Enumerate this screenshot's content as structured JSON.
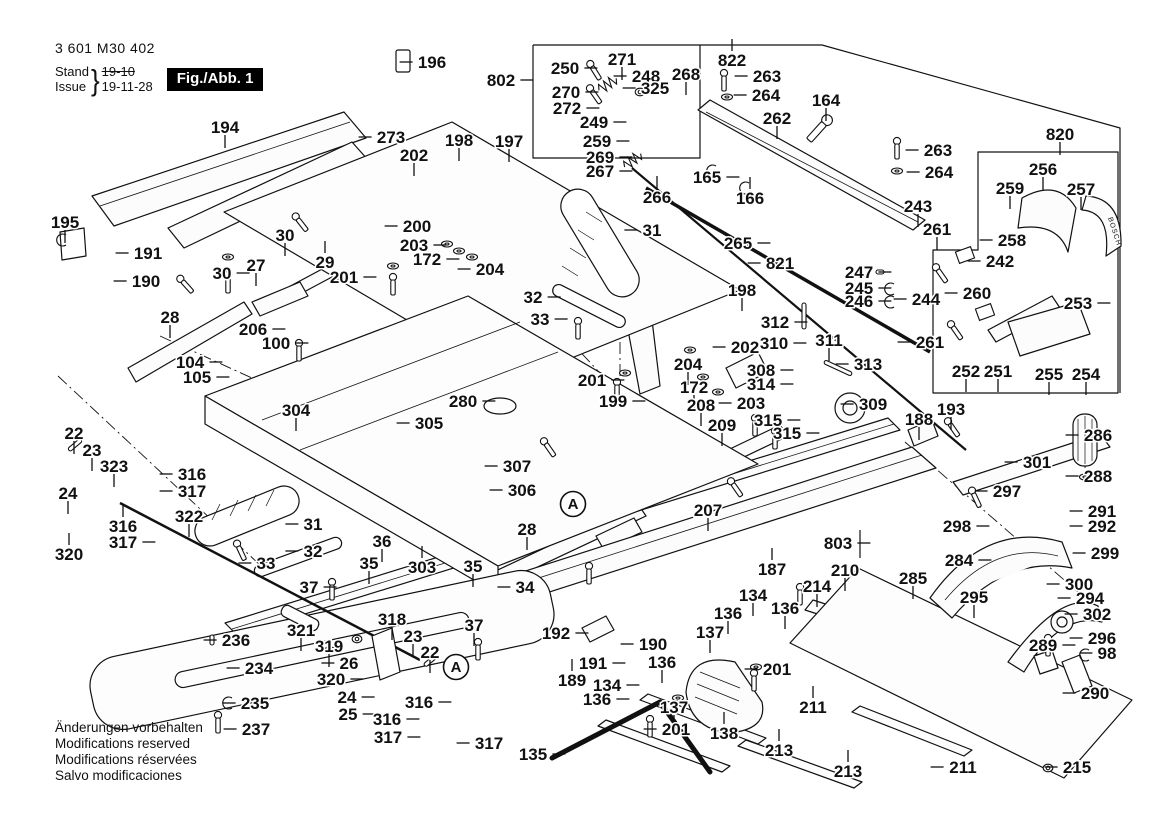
{
  "meta": {
    "part_number": "3 601 M30 402",
    "stand_label": "Stand",
    "issue_label": "Issue",
    "old_date": "19-10",
    "date": "19-11-28",
    "figure": "Fig./Abb. 1"
  },
  "footer": {
    "lines": [
      "Änderungen vorbehalten",
      "Modifications reserved",
      "Modifications réservées",
      "Salvo modificaciones"
    ]
  },
  "brand_text": "BOSCH",
  "assembly_markers": [
    {
      "label": "A",
      "x": 573,
      "y": 504
    },
    {
      "label": "A",
      "x": 456,
      "y": 667
    }
  ],
  "labels": [
    {
      "t": "196",
      "x": 432,
      "y": 62,
      "d": "l"
    },
    {
      "t": "802",
      "x": 501,
      "y": 80,
      "d": "r"
    },
    {
      "t": "250",
      "x": 565,
      "y": 68,
      "d": "r"
    },
    {
      "t": "271",
      "x": 622,
      "y": 59,
      "d": "d"
    },
    {
      "t": "248",
      "x": 646,
      "y": 76,
      "d": "l"
    },
    {
      "t": "268",
      "x": 686,
      "y": 74,
      "d": "d"
    },
    {
      "t": "822",
      "x": 732,
      "y": 60,
      "d": "u"
    },
    {
      "t": "263",
      "x": 767,
      "y": 76,
      "d": "l"
    },
    {
      "t": "264",
      "x": 766,
      "y": 95,
      "d": "l"
    },
    {
      "t": "270",
      "x": 566,
      "y": 92,
      "d": "r"
    },
    {
      "t": "272",
      "x": 567,
      "y": 108,
      "d": "r"
    },
    {
      "t": "325",
      "x": 655,
      "y": 88,
      "d": "l"
    },
    {
      "t": "249",
      "x": 594,
      "y": 122,
      "d": "r"
    },
    {
      "t": "259",
      "x": 597,
      "y": 141,
      "d": "r"
    },
    {
      "t": "269",
      "x": 600,
      "y": 157,
      "d": "r"
    },
    {
      "t": "267",
      "x": 600,
      "y": 171,
      "d": "r"
    },
    {
      "t": "266",
      "x": 657,
      "y": 197,
      "d": "u"
    },
    {
      "t": "165",
      "x": 707,
      "y": 177,
      "d": "r"
    },
    {
      "t": "166",
      "x": 750,
      "y": 198,
      "d": "u"
    },
    {
      "t": "262",
      "x": 777,
      "y": 118,
      "d": "d"
    },
    {
      "t": "164",
      "x": 826,
      "y": 100,
      "d": "d"
    },
    {
      "t": "194",
      "x": 225,
      "y": 127,
      "d": "d"
    },
    {
      "t": "273",
      "x": 391,
      "y": 137,
      "d": "l"
    },
    {
      "t": "198",
      "x": 459,
      "y": 140,
      "d": "d"
    },
    {
      "t": "197",
      "x": 509,
      "y": 141,
      "d": "d"
    },
    {
      "t": "202",
      "x": 414,
      "y": 155,
      "d": "d"
    },
    {
      "t": "263",
      "x": 938,
      "y": 150,
      "d": "l"
    },
    {
      "t": "264",
      "x": 939,
      "y": 172,
      "d": "l"
    },
    {
      "t": "243",
      "x": 918,
      "y": 206,
      "d": "d"
    },
    {
      "t": "820",
      "x": 1060,
      "y": 134,
      "d": "d"
    },
    {
      "t": "256",
      "x": 1043,
      "y": 169,
      "d": "d"
    },
    {
      "t": "259",
      "x": 1010,
      "y": 188,
      "d": "d"
    },
    {
      "t": "257",
      "x": 1081,
      "y": 189,
      "d": "d"
    },
    {
      "t": "258",
      "x": 1012,
      "y": 240,
      "d": "l"
    },
    {
      "t": "242",
      "x": 1000,
      "y": 261,
      "d": "l"
    },
    {
      "t": "261",
      "x": 937,
      "y": 229,
      "d": "d"
    },
    {
      "t": "195",
      "x": 65,
      "y": 222,
      "d": "d"
    },
    {
      "t": "191",
      "x": 148,
      "y": 253,
      "d": "l"
    },
    {
      "t": "190",
      "x": 146,
      "y": 281,
      "d": "l"
    },
    {
      "t": "30",
      "x": 285,
      "y": 235,
      "d": "d"
    },
    {
      "t": "29",
      "x": 325,
      "y": 262,
      "d": "u"
    },
    {
      "t": "27",
      "x": 256,
      "y": 265,
      "d": "d"
    },
    {
      "t": "30",
      "x": 222,
      "y": 273,
      "d": "r"
    },
    {
      "t": "201",
      "x": 344,
      "y": 277,
      "d": "r"
    },
    {
      "t": "200",
      "x": 417,
      "y": 226,
      "d": "l"
    },
    {
      "t": "203",
      "x": 414,
      "y": 245,
      "d": "r"
    },
    {
      "t": "172",
      "x": 427,
      "y": 259,
      "d": "r"
    },
    {
      "t": "204",
      "x": 490,
      "y": 269,
      "d": "l"
    },
    {
      "t": "31",
      "x": 652,
      "y": 230,
      "d": "l"
    },
    {
      "t": "265",
      "x": 738,
      "y": 243,
      "d": "r"
    },
    {
      "t": "821",
      "x": 780,
      "y": 263,
      "d": "l"
    },
    {
      "t": "28",
      "x": 170,
      "y": 317,
      "d": "d"
    },
    {
      "t": "206",
      "x": 253,
      "y": 329,
      "d": "r"
    },
    {
      "t": "100",
      "x": 276,
      "y": 343,
      "d": "r"
    },
    {
      "t": "104",
      "x": 190,
      "y": 362,
      "d": "r"
    },
    {
      "t": "105",
      "x": 197,
      "y": 377,
      "d": "r"
    },
    {
      "t": "198",
      "x": 742,
      "y": 290,
      "d": "d"
    },
    {
      "t": "202",
      "x": 745,
      "y": 347,
      "d": "l"
    },
    {
      "t": "247",
      "x": 859,
      "y": 272,
      "d": "r"
    },
    {
      "t": "245",
      "x": 859,
      "y": 288,
      "d": "r"
    },
    {
      "t": "246",
      "x": 859,
      "y": 301,
      "d": "r"
    },
    {
      "t": "244",
      "x": 926,
      "y": 299,
      "d": "l"
    },
    {
      "t": "261",
      "x": 930,
      "y": 342,
      "d": "l"
    },
    {
      "t": "260",
      "x": 977,
      "y": 293,
      "d": "l"
    },
    {
      "t": "312",
      "x": 775,
      "y": 322,
      "d": "r"
    },
    {
      "t": "310",
      "x": 774,
      "y": 343,
      "d": "r"
    },
    {
      "t": "311",
      "x": 829,
      "y": 340,
      "d": "d"
    },
    {
      "t": "308",
      "x": 761,
      "y": 370,
      "d": "r"
    },
    {
      "t": "314",
      "x": 761,
      "y": 384,
      "d": "r"
    },
    {
      "t": "313",
      "x": 868,
      "y": 364,
      "d": "l"
    },
    {
      "t": "315",
      "x": 768,
      "y": 420,
      "d": "r"
    },
    {
      "t": "315",
      "x": 787,
      "y": 433,
      "d": "r"
    },
    {
      "t": "309",
      "x": 873,
      "y": 404,
      "d": "l"
    },
    {
      "t": "204",
      "x": 688,
      "y": 364,
      "d": "d"
    },
    {
      "t": "172",
      "x": 694,
      "y": 387,
      "d": "d"
    },
    {
      "t": "203",
      "x": 751,
      "y": 403,
      "d": "l"
    },
    {
      "t": "208",
      "x": 701,
      "y": 405,
      "d": "d"
    },
    {
      "t": "209",
      "x": 722,
      "y": 425,
      "d": "d"
    },
    {
      "t": "201",
      "x": 592,
      "y": 380,
      "d": "r"
    },
    {
      "t": "199",
      "x": 613,
      "y": 401,
      "d": "r"
    },
    {
      "t": "188",
      "x": 919,
      "y": 419,
      "d": "d"
    },
    {
      "t": "193",
      "x": 951,
      "y": 409,
      "d": "d"
    },
    {
      "t": "253",
      "x": 1078,
      "y": 303,
      "d": "r"
    },
    {
      "t": "252",
      "x": 966,
      "y": 371,
      "d": "d"
    },
    {
      "t": "251",
      "x": 998,
      "y": 371,
      "d": "d"
    },
    {
      "t": "255",
      "x": 1049,
      "y": 374,
      "d": "d"
    },
    {
      "t": "254",
      "x": 1086,
      "y": 374,
      "d": "d"
    },
    {
      "t": "286",
      "x": 1098,
      "y": 435,
      "d": "l"
    },
    {
      "t": "301",
      "x": 1037,
      "y": 462,
      "d": "l"
    },
    {
      "t": "288",
      "x": 1098,
      "y": 476,
      "d": "l"
    },
    {
      "t": "280",
      "x": 463,
      "y": 401,
      "d": "r"
    },
    {
      "t": "305",
      "x": 429,
      "y": 423,
      "d": "l"
    },
    {
      "t": "307",
      "x": 517,
      "y": 466,
      "d": "l"
    },
    {
      "t": "306",
      "x": 522,
      "y": 490,
      "d": "l"
    },
    {
      "t": "22",
      "x": 74,
      "y": 433,
      "d": "d"
    },
    {
      "t": "23",
      "x": 92,
      "y": 450,
      "d": "d"
    },
    {
      "t": "323",
      "x": 114,
      "y": 466,
      "d": "d"
    },
    {
      "t": "24",
      "x": 68,
      "y": 493,
      "d": "d"
    },
    {
      "t": "316",
      "x": 192,
      "y": 474,
      "d": "l"
    },
    {
      "t": "317",
      "x": 192,
      "y": 491,
      "d": "l"
    },
    {
      "t": "316",
      "x": 123,
      "y": 526,
      "d": "u"
    },
    {
      "t": "317",
      "x": 123,
      "y": 542,
      "d": "r"
    },
    {
      "t": "320",
      "x": 69,
      "y": 554,
      "d": "u"
    },
    {
      "t": "322",
      "x": 189,
      "y": 516,
      "d": "d"
    },
    {
      "t": "31",
      "x": 313,
      "y": 524,
      "d": "l"
    },
    {
      "t": "32",
      "x": 313,
      "y": 551,
      "d": "l"
    },
    {
      "t": "33",
      "x": 266,
      "y": 563,
      "d": "l"
    },
    {
      "t": "36",
      "x": 382,
      "y": 541,
      "d": "d"
    },
    {
      "t": "35",
      "x": 369,
      "y": 563,
      "d": "d"
    },
    {
      "t": "32",
      "x": 533,
      "y": 297,
      "d": "r"
    },
    {
      "t": "33",
      "x": 540,
      "y": 319,
      "d": "r"
    },
    {
      "t": "28",
      "x": 527,
      "y": 529,
      "d": "d"
    },
    {
      "t": "35",
      "x": 473,
      "y": 566,
      "d": "d"
    },
    {
      "t": "34",
      "x": 525,
      "y": 587,
      "d": "l"
    },
    {
      "t": "37",
      "x": 474,
      "y": 625,
      "d": "d"
    },
    {
      "t": "37",
      "x": 309,
      "y": 587,
      "d": "r"
    },
    {
      "t": "303",
      "x": 422,
      "y": 567,
      "d": "u"
    },
    {
      "t": "318",
      "x": 392,
      "y": 619,
      "d": "d"
    },
    {
      "t": "23",
      "x": 413,
      "y": 636,
      "d": "d"
    },
    {
      "t": "22",
      "x": 430,
      "y": 652,
      "d": "d"
    },
    {
      "t": "26",
      "x": 349,
      "y": 663,
      "d": "l"
    },
    {
      "t": "320",
      "x": 331,
      "y": 679,
      "d": "r"
    },
    {
      "t": "24",
      "x": 347,
      "y": 697,
      "d": "r"
    },
    {
      "t": "25",
      "x": 348,
      "y": 714,
      "d": "r"
    },
    {
      "t": "316",
      "x": 419,
      "y": 702,
      "d": "r"
    },
    {
      "t": "316",
      "x": 387,
      "y": 719,
      "d": "r"
    },
    {
      "t": "317",
      "x": 388,
      "y": 737,
      "d": "r"
    },
    {
      "t": "317",
      "x": 489,
      "y": 743,
      "d": "l"
    },
    {
      "t": "321",
      "x": 301,
      "y": 630,
      "d": "d"
    },
    {
      "t": "319",
      "x": 329,
      "y": 646,
      "d": "d"
    },
    {
      "t": "236",
      "x": 236,
      "y": 640,
      "d": "l"
    },
    {
      "t": "234",
      "x": 259,
      "y": 668,
      "d": "l"
    },
    {
      "t": "235",
      "x": 255,
      "y": 703,
      "d": "l"
    },
    {
      "t": "237",
      "x": 256,
      "y": 729,
      "d": "l"
    },
    {
      "t": "192",
      "x": 556,
      "y": 633,
      "d": "r"
    },
    {
      "t": "190",
      "x": 653,
      "y": 644,
      "d": "l"
    },
    {
      "t": "191",
      "x": 593,
      "y": 663,
      "d": "r"
    },
    {
      "t": "189",
      "x": 572,
      "y": 680,
      "d": "u"
    },
    {
      "t": "134",
      "x": 753,
      "y": 595,
      "d": "d"
    },
    {
      "t": "136",
      "x": 728,
      "y": 613,
      "d": "d"
    },
    {
      "t": "136",
      "x": 785,
      "y": 608,
      "d": "d"
    },
    {
      "t": "137",
      "x": 710,
      "y": 632,
      "d": "d"
    },
    {
      "t": "134",
      "x": 607,
      "y": 685,
      "d": "r"
    },
    {
      "t": "136",
      "x": 597,
      "y": 699,
      "d": "r"
    },
    {
      "t": "136",
      "x": 662,
      "y": 662,
      "d": "d"
    },
    {
      "t": "137",
      "x": 674,
      "y": 707,
      "d": "d"
    },
    {
      "t": "201",
      "x": 777,
      "y": 669,
      "d": "l"
    },
    {
      "t": "201",
      "x": 676,
      "y": 729,
      "d": "l"
    },
    {
      "t": "135",
      "x": 533,
      "y": 754,
      "d": "r"
    },
    {
      "t": "138",
      "x": 724,
      "y": 733,
      "d": "u"
    },
    {
      "t": "207",
      "x": 708,
      "y": 510,
      "d": "d"
    },
    {
      "t": "187",
      "x": 772,
      "y": 569,
      "d": "u"
    },
    {
      "t": "803",
      "x": 838,
      "y": 543,
      "d": "r"
    },
    {
      "t": "210",
      "x": 845,
      "y": 570,
      "d": "d"
    },
    {
      "t": "214",
      "x": 817,
      "y": 586,
      "d": "d"
    },
    {
      "t": "285",
      "x": 913,
      "y": 578,
      "d": "d"
    },
    {
      "t": "295",
      "x": 974,
      "y": 597,
      "d": "d"
    },
    {
      "t": "284",
      "x": 959,
      "y": 560,
      "d": "r"
    },
    {
      "t": "297",
      "x": 1007,
      "y": 491,
      "d": "l"
    },
    {
      "t": "298",
      "x": 957,
      "y": 526,
      "d": "r"
    },
    {
      "t": "291",
      "x": 1102,
      "y": 511,
      "d": "l"
    },
    {
      "t": "292",
      "x": 1102,
      "y": 526,
      "d": "l"
    },
    {
      "t": "299",
      "x": 1105,
      "y": 553,
      "d": "l"
    },
    {
      "t": "300",
      "x": 1079,
      "y": 584,
      "d": "l"
    },
    {
      "t": "294",
      "x": 1090,
      "y": 598,
      "d": "l"
    },
    {
      "t": "302",
      "x": 1097,
      "y": 614,
      "d": "l"
    },
    {
      "t": "296",
      "x": 1102,
      "y": 638,
      "d": "l"
    },
    {
      "t": "98",
      "x": 1107,
      "y": 653,
      "d": "l"
    },
    {
      "t": "289",
      "x": 1043,
      "y": 645,
      "d": "r"
    },
    {
      "t": "290",
      "x": 1095,
      "y": 693,
      "d": "l"
    },
    {
      "t": "211",
      "x": 813,
      "y": 707,
      "d": "u"
    },
    {
      "t": "213",
      "x": 779,
      "y": 750,
      "d": "u"
    },
    {
      "t": "213",
      "x": 848,
      "y": 771,
      "d": "u"
    },
    {
      "t": "211",
      "x": 963,
      "y": 767,
      "d": "l"
    },
    {
      "t": "215",
      "x": 1077,
      "y": 767,
      "d": "l"
    },
    {
      "t": "304",
      "x": 296,
      "y": 410,
      "d": "d"
    }
  ]
}
